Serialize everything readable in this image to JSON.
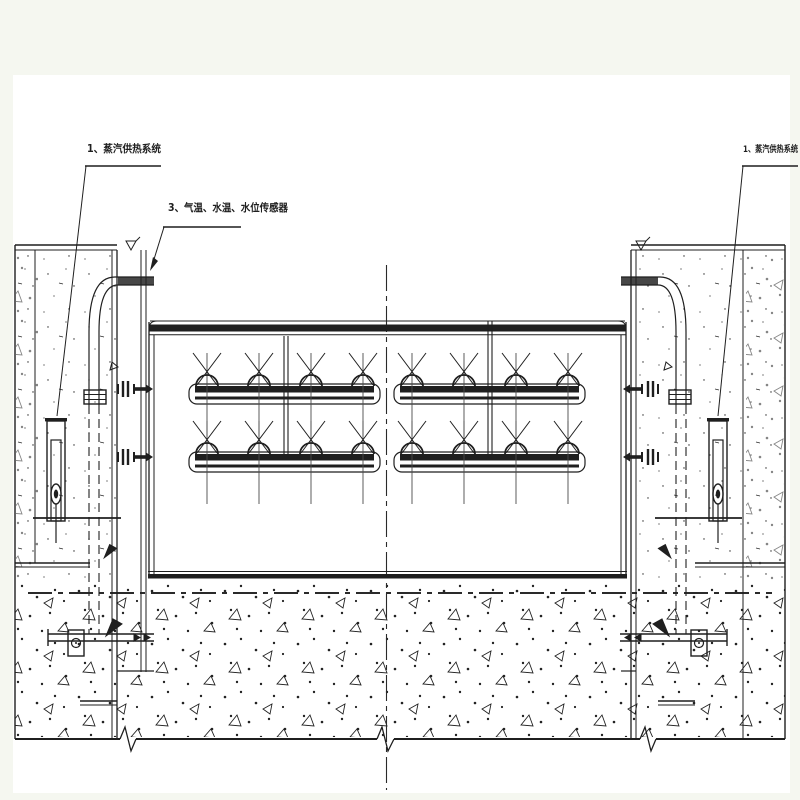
{
  "drawing": {
    "type": "engineering-cross-section",
    "labels": {
      "steam_left": "1、蒸汽供热系统",
      "sensors": "3、气温、水温、水位传感器",
      "steam_right": "1、蒸汽供热系统"
    },
    "colors": {
      "background": "#f5f7f0",
      "paper": "#ffffff",
      "ink": "#1f1f1f"
    }
  }
}
